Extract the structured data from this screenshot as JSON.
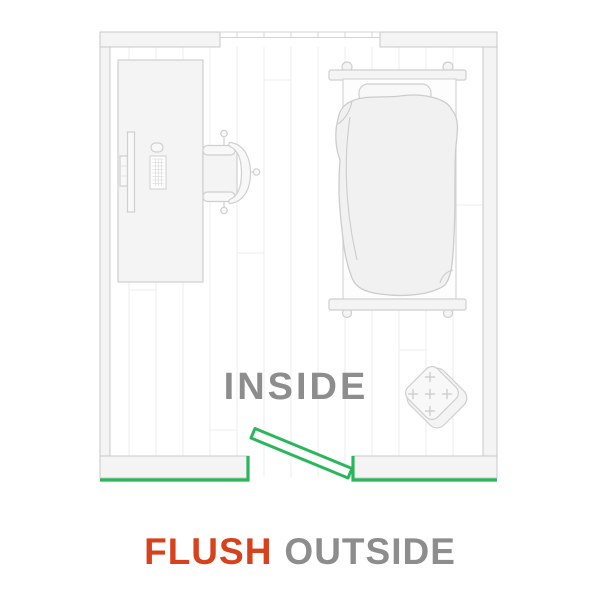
{
  "illustration": {
    "room_label": "INSIDE",
    "caption": {
      "highlight": "FLUSH",
      "rest": "OUTSIDE"
    },
    "objects": [
      {
        "name": "desk-with-monitor-keyboard-mouse"
      },
      {
        "name": "office-chair"
      },
      {
        "name": "bed-with-pillow-and-duvet"
      },
      {
        "name": "tufted-ottoman"
      },
      {
        "name": "cabinet"
      },
      {
        "name": "open-door-leaf"
      },
      {
        "name": "window"
      }
    ]
  },
  "colors": {
    "accent_green": "#2ab75c",
    "accent_red": "#d7421d",
    "label_gray": "#8d8d8d",
    "wall_fill": "#f4f4f4",
    "wall_stroke": "#c9c9c9",
    "furn_stroke": "#cfcfcf",
    "furn_fill": "#f4f4f4",
    "floor_line": "#ededed"
  }
}
